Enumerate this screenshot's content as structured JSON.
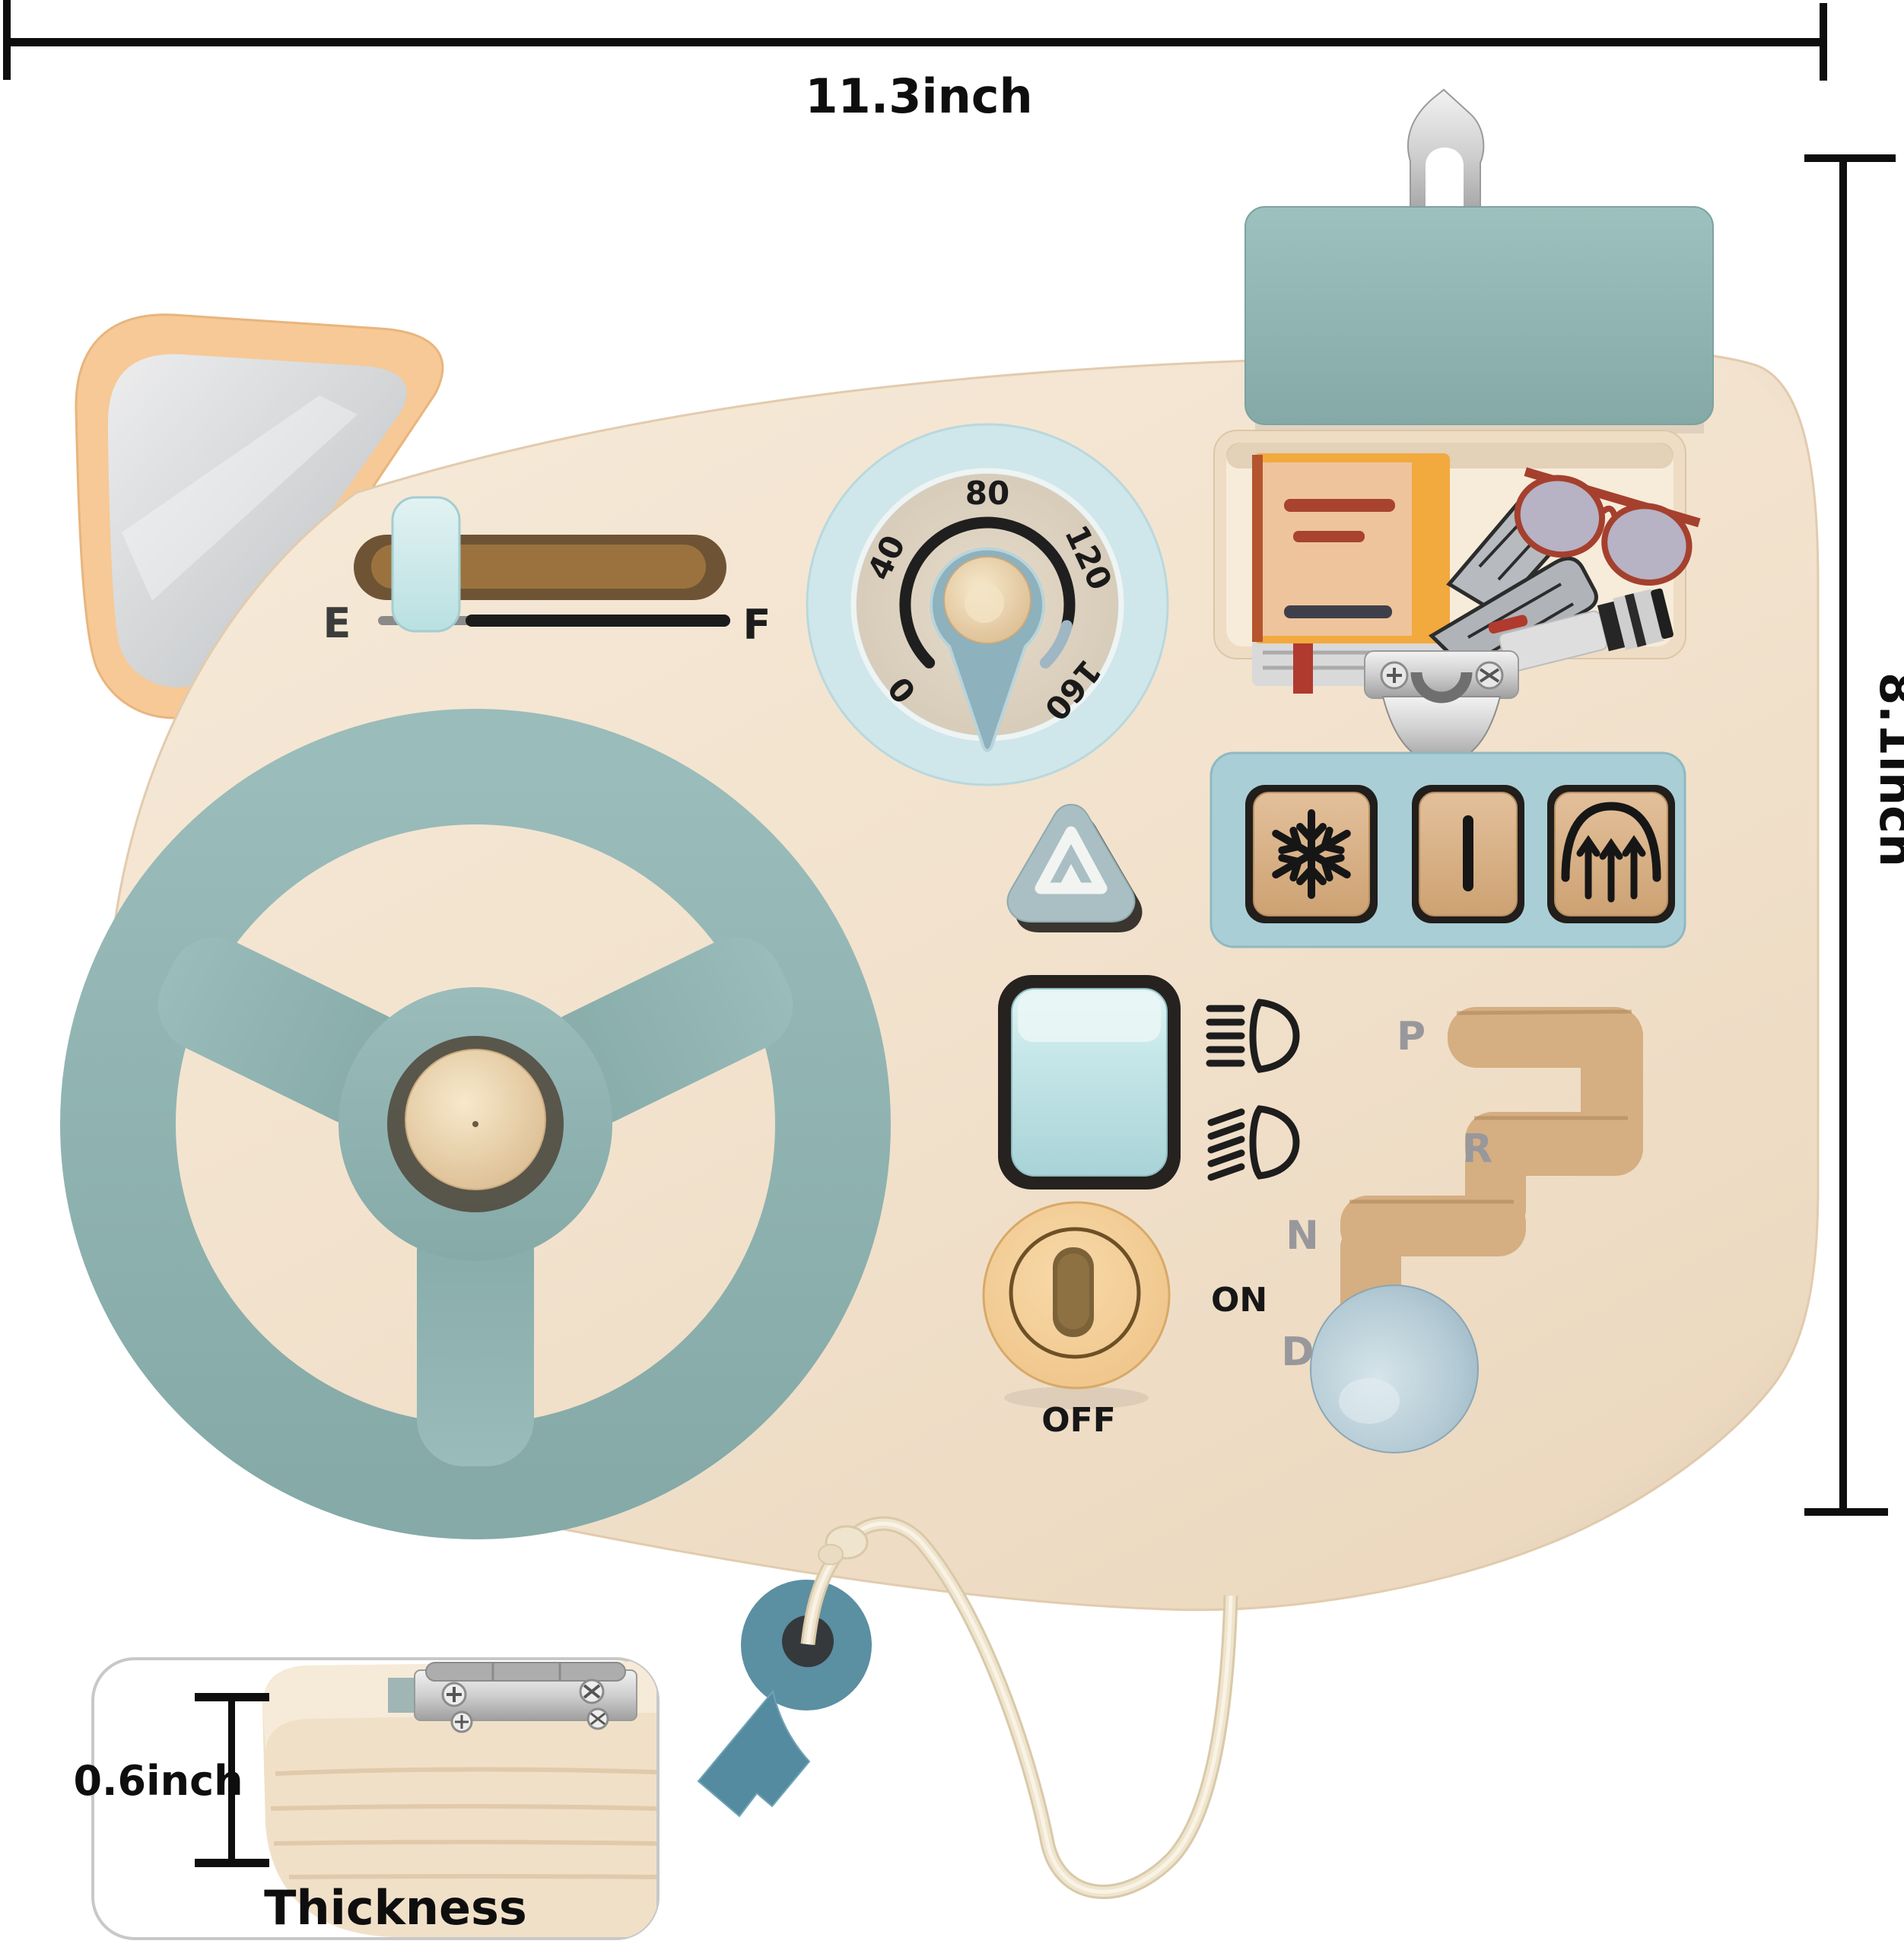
{
  "dimension_annotations": {
    "width": "11.3inch",
    "height": "8.1inch",
    "thickness_value": "0.6inch",
    "thickness_label": "Thickness"
  },
  "board": {
    "fuel_gauge": {
      "empty": "E",
      "full": "F"
    },
    "speedometer": {
      "ticks": [
        "0",
        "40",
        "80",
        "120",
        "160"
      ]
    },
    "ignition": {
      "on": "ON",
      "off": "OFF"
    },
    "gear_shifter": {
      "positions": [
        "P",
        "R",
        "N",
        "D"
      ]
    }
  },
  "colors": {
    "board_wood": "#f2e4d2",
    "steering_wheel": "#8fb4b2",
    "speedometer_ring": "#cfe7ea",
    "glovebox_lid": "#92b7b4",
    "button_panel": "#a9ced6",
    "mirror_frame": "#f6c996",
    "ignition_dial": "#f4cf9b",
    "gear_knob": "#a9c2cf",
    "key": "#5b8fa2",
    "rope": "#efe4cd",
    "dimension_lines": "#111111"
  }
}
